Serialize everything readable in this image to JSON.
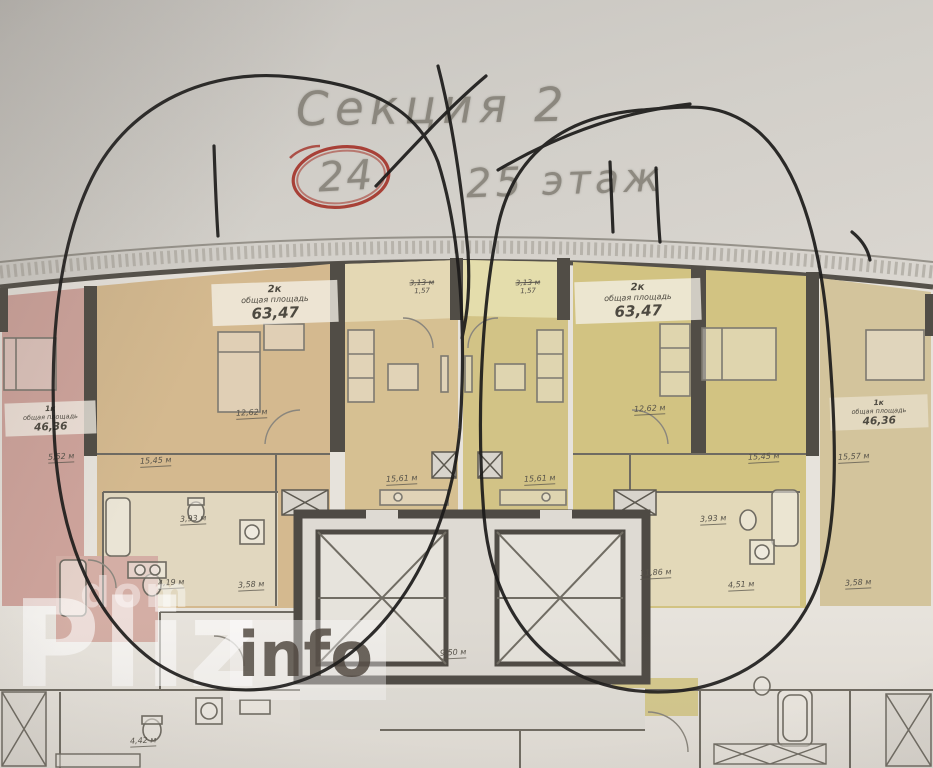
{
  "header": {
    "section": "Секция 2",
    "floor_circled": "24",
    "floor_rest": "25 этаж"
  },
  "apartments": {
    "pink_1k": {
      "type": "1к",
      "area_label": "общая площадь",
      "area": "46,36"
    },
    "tan_2k": {
      "type": "2к",
      "area_label": "общая площадь",
      "area": "63,47"
    },
    "yellow_2k": {
      "type": "2к",
      "area_label": "общая площадь",
      "area": "63,47"
    },
    "beige_1k": {
      "type": "1к",
      "area_label": "общая площадь",
      "area": "46,36"
    }
  },
  "balconies": [
    {
      "full": "3,13 м",
      "reduced": "1,57"
    },
    {
      "full": "3,13 м",
      "reduced": "1,57"
    }
  ],
  "rooms": [
    "12,62 м",
    "15,45 м",
    "3,93 м",
    "4,19 м",
    "5,52 м",
    "3,58 м",
    "15,61 м",
    "15,61 м",
    "9,50 м",
    "4,42 м",
    "12,62 м",
    "15,45 м",
    "3,93 м",
    "4,51 м",
    "11,86 м",
    "3,58 м",
    "15,57 м"
  ],
  "watermark": {
    "top": "dom",
    "big": "Pliz",
    "suffix": "info"
  },
  "colors": {
    "pen": "#1c1b1a",
    "red_circle": "#a33127",
    "walls": "#514d46",
    "pink_apartment": "#cfa49c",
    "tan_apartment": "#d4b98f",
    "yellow_apartment": "#d2c386",
    "beige_apartment": "#d3c49c"
  }
}
